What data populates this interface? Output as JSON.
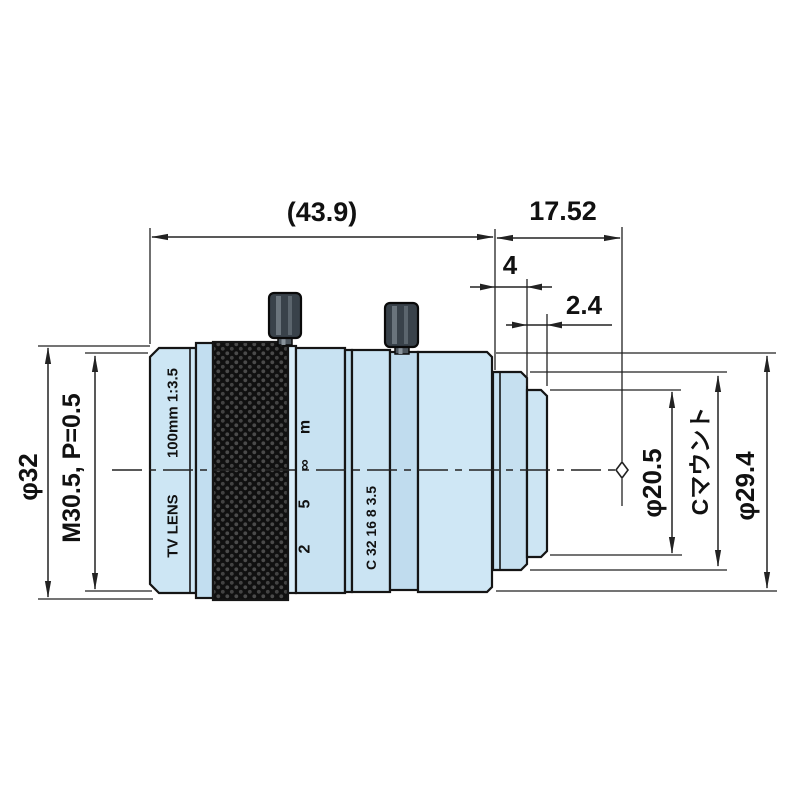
{
  "drawing": {
    "title": "c-mount-tv-lens-dimension-drawing",
    "dimensions": {
      "overall_length": "(43.9)",
      "flange_focal_distance": "17.52",
      "flange_width": "4",
      "thread_protrusion": "2.4",
      "front_outer_diameter": "φ32",
      "filter_thread": "M30.5, P=0.5",
      "mount_thread_diameter": "φ20.5",
      "mount_label": "Cマウント",
      "rear_outer_diameter": "φ29.4"
    },
    "lens_markings": {
      "brand_line": "TV LENS",
      "spec_line": "100mm 1:3.5",
      "focus_scale": [
        "2",
        "5",
        "∞",
        "m"
      ],
      "aperture_scale": "C 32 16 8 3.5"
    },
    "colors": {
      "body_blue": "#cde6f4",
      "body_blue_dark": "#bddcee",
      "body_blue_light": "#d9edf9",
      "outline": "#151515",
      "knurl_black": "#101010",
      "dimension_line": "#222222"
    }
  }
}
